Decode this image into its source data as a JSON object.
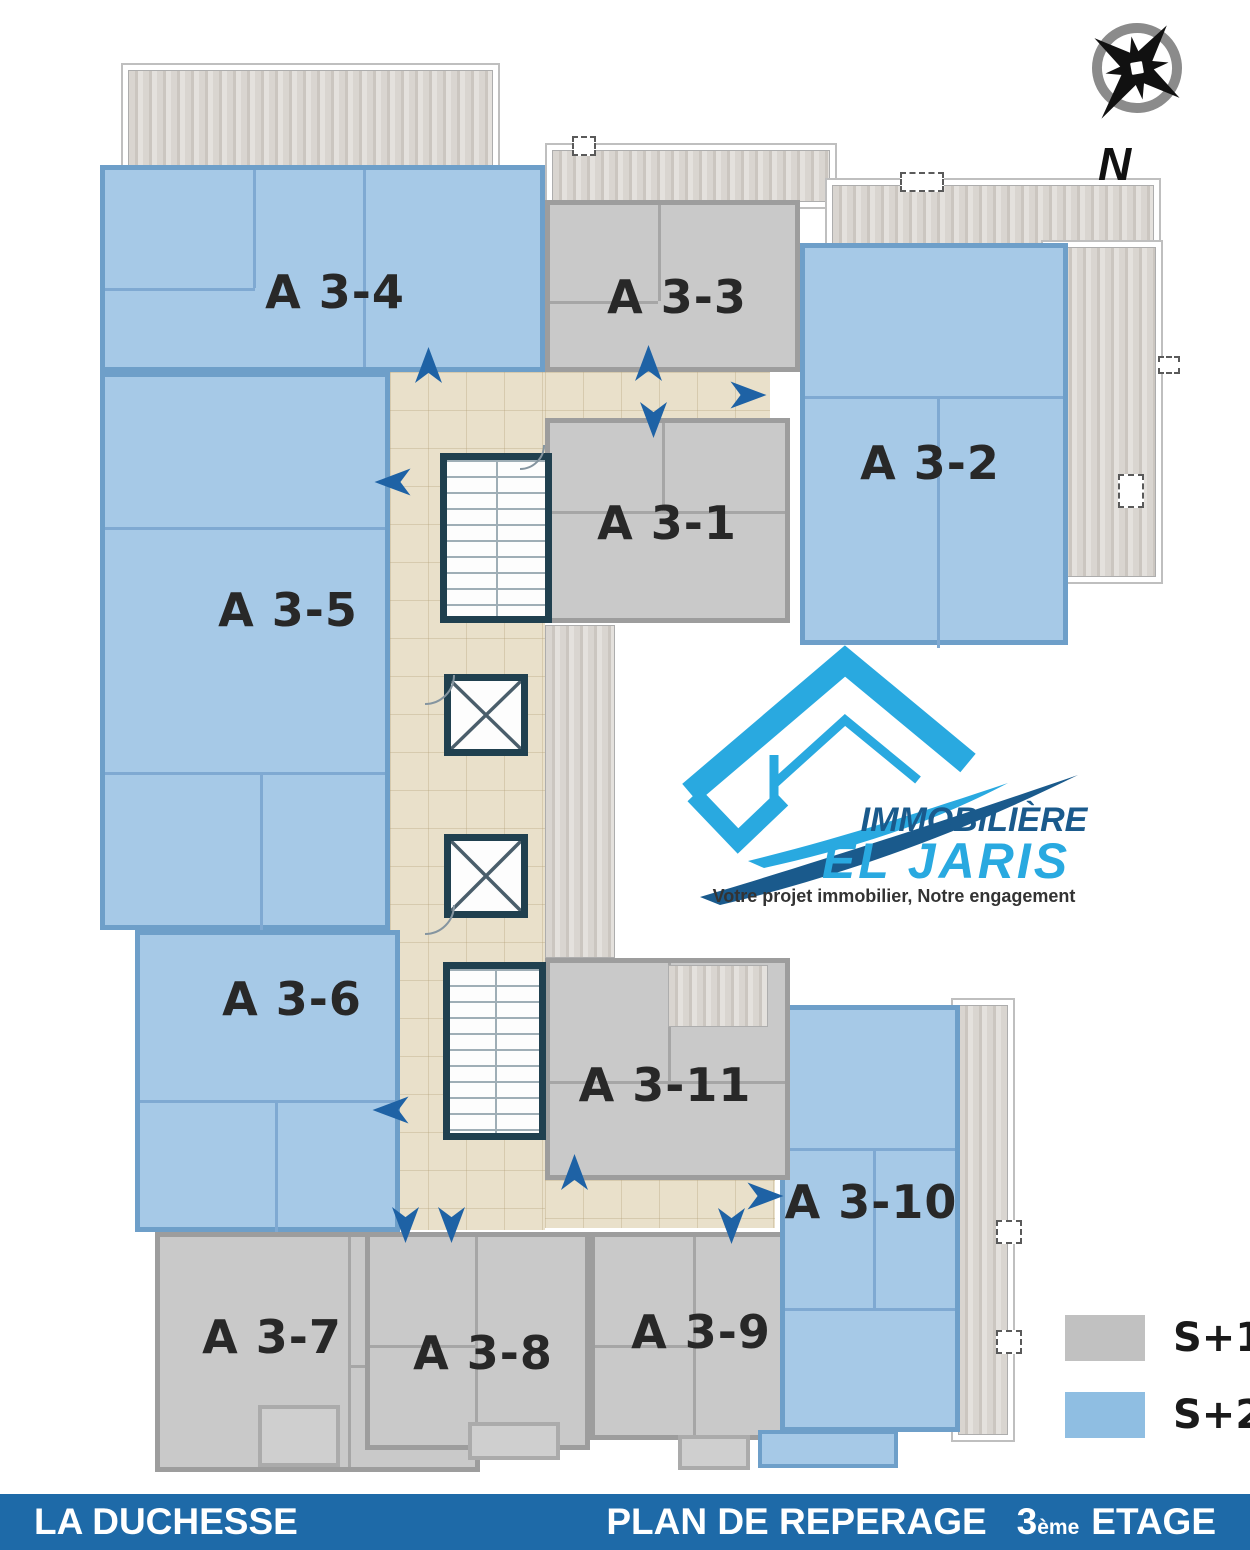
{
  "compass": {
    "label": "N"
  },
  "logo": {
    "line1": "IMMOBILIÈRE",
    "line2": "EL JARIS",
    "tagline": "Votre projet immobilier, Notre engagement",
    "light_blue": "#29A9E0",
    "dark_blue": "#1A5A8C"
  },
  "legend": {
    "items": [
      {
        "label": "S+1",
        "color": "#C1C1C1"
      },
      {
        "label": "S+2",
        "color": "#8FBEE2"
      }
    ]
  },
  "apartments": [
    {
      "id": "A3-1",
      "label": "A 3-1",
      "type": "S+1"
    },
    {
      "id": "A3-2",
      "label": "A 3-2",
      "type": "S+2"
    },
    {
      "id": "A3-3",
      "label": "A 3-3",
      "type": "S+1"
    },
    {
      "id": "A3-4",
      "label": "A 3-4",
      "type": "S+2"
    },
    {
      "id": "A3-5",
      "label": "A 3-5",
      "type": "S+2"
    },
    {
      "id": "A3-6",
      "label": "A 3-6",
      "type": "S+2"
    },
    {
      "id": "A3-7",
      "label": "A 3-7",
      "type": "S+1"
    },
    {
      "id": "A3-8",
      "label": "A 3-8",
      "type": "S+1"
    },
    {
      "id": "A3-9",
      "label": "A 3-9",
      "type": "S+1"
    },
    {
      "id": "A3-10",
      "label": "A 3-10",
      "type": "S+2"
    },
    {
      "id": "A3-11",
      "label": "A 3-11",
      "type": "S+1"
    }
  ],
  "footer": {
    "project": "LA DUCHESSE",
    "plan_title": "PLAN DE REPERAGE",
    "floor_number": "3",
    "floor_ordinal": "ème",
    "floor_word": "ETAGE"
  },
  "colors": {
    "s1_fill": "#C9C9C9",
    "s2_fill": "#A6C9E7",
    "corridor": "#E9E0CA",
    "core_wall": "#20404F",
    "arrow": "#1E62A5",
    "footer_bar": "#1E6AA8"
  }
}
